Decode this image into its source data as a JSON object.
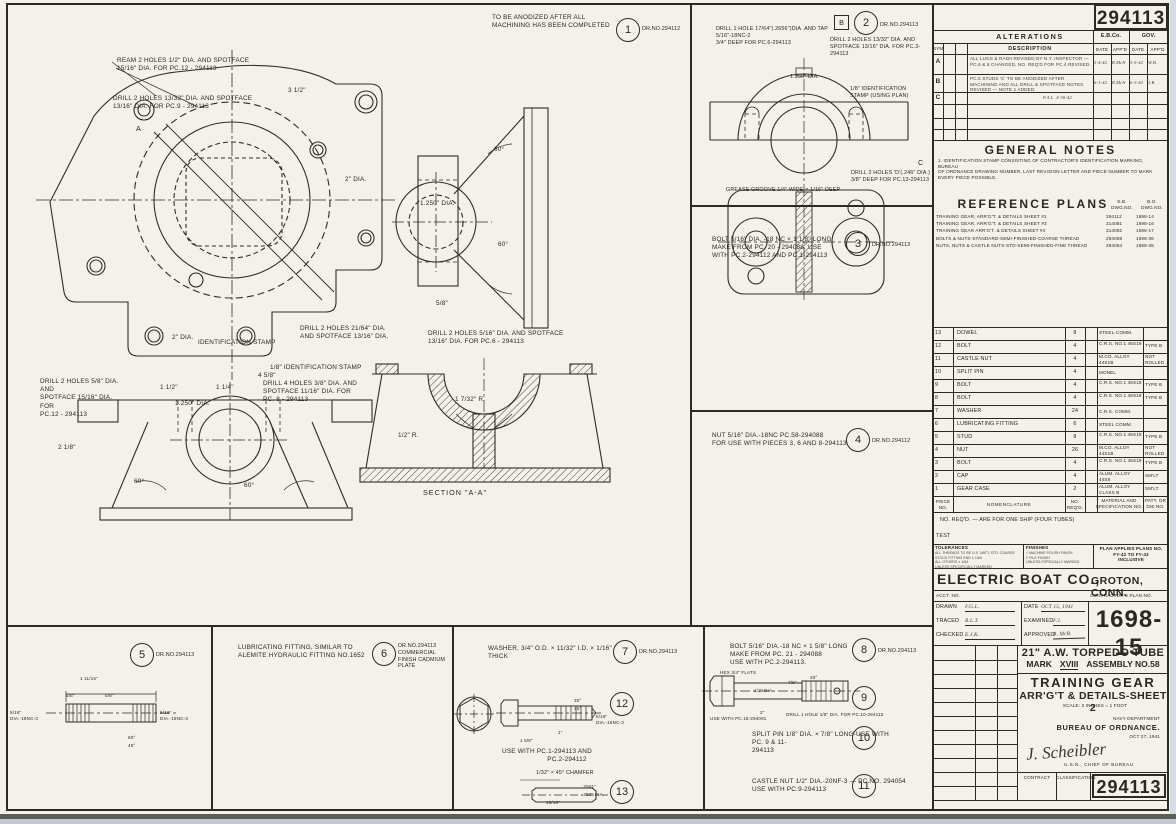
{
  "sheet": {
    "number_top": "294113",
    "number_bottom": "294113",
    "drno": "DR.NO.294113",
    "drno2": "DR.NO.294112"
  },
  "alterations": {
    "title": "ALTERATIONS",
    "ebco": "E.B.Co.",
    "gov": "GOV.",
    "description": "DESCRIPTION",
    "date": "DATE",
    "appd": "APP'D",
    "sym": "SYM",
    "rows": [
      {
        "ltr": "A",
        "desc": "ALL LUGS & RADII REVISED BY N.Y. INSPECTOR — PC.6 & 8 CHANGED, NO. REQ'D FOR PC.4 REVISED.",
        "eb_date": "3-4-42",
        "eb_appd": "R.McN",
        "gov_date": "3-5-42",
        "gov_appd": "W.B."
      },
      {
        "ltr": "B",
        "desc": "PC.5 STUDS 'C' TO BE ANODIZED AFTER MACHINING AND ALL DRILL & SPOTFACE NOTES REVISED — NOTE 1 ADDED.",
        "eb_date": "6-1-42",
        "eb_appd": "R.McN",
        "gov_date": "6-3-42",
        "gov_appd": "J.B."
      },
      {
        "ltr": "C",
        "desc": "",
        "eb_date": "",
        "eb_appd": "",
        "gov_date": "",
        "gov_appd": ""
      }
    ],
    "side_note": "F.A.L. 4-30-42"
  },
  "general_notes": {
    "title": "GENERAL NOTES",
    "note_l1": "1. IDENTIFICATION STAMP CONSISTING OF CONTRACTOR'S IDENTIFICATION MARKING, BUREAU",
    "note_l2": "OF ORDNANCE DRAWING NUMBER, LAST REVISION LETTER AND PIECE NUMBER TO MARK",
    "note_l3": "EVERY PIECE POSSIBLE."
  },
  "reference_plans": {
    "title": "REFERENCE PLANS",
    "col1a": "E.B.",
    "col1b": "DWG.NO.",
    "col2a": "B.O.",
    "col2b": "DWG.NO.",
    "rows": [
      {
        "name": "TRAINING GEAR, ARR'G'T. & DETAILS SHEET #1",
        "eb": "294112",
        "bo": "1698-14"
      },
      {
        "name": "TRAINING GEAR, ARR'G'T. & DETAILS SHEET #3",
        "eb": "314081",
        "bo": "1698-16"
      },
      {
        "name": "TRAINING GEAR ARR'G'T. & DETAILS SHEET #4",
        "eb": "314082",
        "bo": "1698-17"
      },
      {
        "name": "BOLTS & NUTS-STANDARD-SEMI-FINISHED-COARSE THREAD",
        "eb": "294088",
        "bo": "1698-36"
      },
      {
        "name": "NUTS, NUTS & CASTLE NUTS-STD-SEMI-FINISHED-FINE THREAD",
        "eb": "294054",
        "bo": "1698-35"
      }
    ]
  },
  "parts": {
    "rows": [
      {
        "no": "13",
        "name": "DOWEL",
        "qty": "8",
        "mat": "STEEL-COMM.",
        "note": ""
      },
      {
        "no": "12",
        "name": "BOLT",
        "qty": "4",
        "mat": "C.R.S. NO.1 46S18",
        "note": "TYPE B"
      },
      {
        "no": "11",
        "name": "CASTLE NUT",
        "qty": "4",
        "mat": "M.CO. ALLOY 44S1B",
        "note": "NOT ROLLED"
      },
      {
        "no": "10",
        "name": "SPLIT PIN",
        "qty": "4",
        "mat": "MONEL",
        "note": ""
      },
      {
        "no": "9",
        "name": "BOLT",
        "qty": "4",
        "mat": "C.R.S. NO.1 46S18",
        "note": "TYPE B"
      },
      {
        "no": "8",
        "name": "BOLT",
        "qty": "4",
        "mat": "C.R.S. NO.1 46S18",
        "note": "TYPE B"
      },
      {
        "no": "7",
        "name": "WASHER",
        "qty": "24",
        "mat": "C.R.S. COMM.",
        "note": ""
      },
      {
        "no": "6",
        "name": "LUBRICATING FITTING",
        "qty": "6",
        "mat": "STEEL COMM.",
        "note": ""
      },
      {
        "no": "5",
        "name": "STUD",
        "qty": "8",
        "mat": "C.R.S. NO.1 46S18",
        "note": "TYPE B"
      },
      {
        "no": "4",
        "name": "NUT",
        "qty": "26",
        "mat": "M.CO. ALLOY 44S1B",
        "note": "NOT ROLLED"
      },
      {
        "no": "3",
        "name": "BOLT",
        "qty": "4",
        "mat": "C.R.S. NO.1 46S18",
        "note": "TYPE B"
      },
      {
        "no": "2",
        "name": "CAP",
        "qty": "4",
        "mat": "ALUM. ALLOY 44S8",
        "note": "SM'LT"
      },
      {
        "no": "1",
        "name": "GEAR CASE",
        "qty": "2",
        "mat": "ALUM. ALLOY CLASS B",
        "note": "SM'LT"
      }
    ],
    "hdr_no": "PIECE NO.",
    "hdr_name": "NOMENCLATURE",
    "hdr_qty": "NO. REQ'D.",
    "hdr_mat": "MATERIAL AND SPECIFICATION NO.",
    "hdr_note": "PATT. OR DIE NO.",
    "footnote": "NO. REQ'D. — ARE FOR ONE SHIP (FOUR TUBES)",
    "test": "TEST"
  },
  "title_block": {
    "tolerances": "TOLERANCES",
    "tol1": "ALL THREADS TO BE U.S. NAT'L STD. COARSE",
    "tol2": "STOCK FITTING END ± 1/64",
    "tol3": "ALL OTHERS ± 1/64",
    "tol4": "UNLESS SPECIFICALLY MARKED",
    "finishes": "FINISHES",
    "fin1": "√ MACHINE POLISH FINISH",
    "fin2": "F FILE FINISH",
    "fin3": "UNLESS ESPECIALLY MARKED",
    "applies1": "PLAN APPLIES PLANS NO.",
    "applies2": "FY-42 TO FY-43",
    "applies3": "INCLUSIVE",
    "company": "ELECTRIC BOAT CO.,",
    "city": "GROTON, CONN.",
    "acct": "ACCT. NO.",
    "contractors": "CONTRACTOR'S PLAN NO.",
    "drawn_label": "DRAWN",
    "drawn": "F.G.L.",
    "date_label": "DATE",
    "date": "OCT 15, 1941",
    "traced_label": "TRACED",
    "traced": "B.L.T.",
    "examined_label": "EXAMINED",
    "examined": "F.J.",
    "checked_label": "CHECKED",
    "checked": "E.J.K.",
    "approved_label": "APPROVED",
    "approved": "R. McB.",
    "plan_no": "1698-15",
    "tube": "21\" A.W. TORPEDO TUBE",
    "mark_label": "MARK",
    "mark": "XVIII",
    "assembly": "ASSEMBLY NO.58",
    "gear_title": "TRAINING GEAR",
    "gear_sub": "ARR'G'T & DETAILS-SHEET 2",
    "scale": "SCALE: 3 INCHES = 1 FOOT",
    "dept": "NAVY DEPARTMENT",
    "bureau": "BUREAU OF ORDNANCE.",
    "date2": "OCT 27, 1941",
    "signature": "J. Scheibler",
    "sig_sub": "U.S.N., CHIEF OF BUREAU",
    "contract": "CONTRACT",
    "classification": "CLASSIFICATION"
  },
  "det1": {
    "n": "1",
    "l1": "TO BE ANODIZED AFTER ALL",
    "l2": "MACHINING HAS BEEN COMPLETED"
  },
  "det2": {
    "n": "2",
    "b": "B",
    "c": "C",
    "tap1": "DRILL 1 HOLE 17/64\"(.2656\")DIA. AND TAP 5/16\"-18NC-2",
    "tap2": "3/4\" DEEP FOR PC.6-294113",
    "dr1": "DRILL 2 HOLES 13/32\" DIA. AND",
    "dr2": "SPOTFACE 13/16\" DIA. FOR PC.3-294113",
    "bore": "1.250\" DIA.",
    "id1": "1/8\" IDENTIFICATION",
    "id2": "STAMP (USING PLAN)",
    "dd1": "DRILL 2 HOLES 'D'(.246\" DIA.)",
    "dd2": "3/8\" DEEP FOR PC.13-294113",
    "groove": "GREASE GROOVE 1/4\" WIDE × 1/16\" DEEP"
  },
  "det3": {
    "n": "3",
    "l1": "BOLT 5/16\" DIA. -18 NC × 1 1/8\" LONG",
    "l2": "MAKE FROM PC. 20 - 294088. USE",
    "l3": "WITH PC.2-294112 AND PC.1-294113"
  },
  "det4": {
    "n": "4",
    "l1": "NUT 5/16\" DIA.-18NC PC.58-294088",
    "l2": "FOR USE WITH PIECES 3, 6 AND 8-294113"
  },
  "det5": {
    "n": "5",
    "thread": "5/16\" DIA.-18NC-3",
    "len": "1 11/16\"",
    "t": "5/8\"",
    "a60": "60°",
    "a45": "45°"
  },
  "det6": {
    "n": "6",
    "l1": "LUBRICATING FITTING, SIMILAR TO",
    "l2": "ALEMITE HYDRAULIC FITTING NO.1652",
    "f1": "COMMERCIAL",
    "f2": "FINISH CADMIUM",
    "f3": "PLATE"
  },
  "det7": {
    "n": "7",
    "text": "WASHER, 3/4\" O.D. × 11/32\" I.D. × 1/16\" THICK"
  },
  "det8": {
    "n": "8",
    "l1": "BOLT 5/16\" DIA.-18 NC × 1 5/8\" LONG",
    "l2": "MAKE FROM PC. 21 - 294088",
    "l3": "USE WITH PC.2-294113."
  },
  "det9": {
    "n": "9",
    "hex": "HEX 3/4\" FLATS",
    "dia": "1/2\" DIA.",
    "d78": "7/8\"",
    "d2": "2\"",
    "a30": "30°",
    "drill": "DRILL 1 HOLE 1/8\" DIA. FOR PC.10-294113",
    "use": "USE WITH PC.15-294091"
  },
  "det10": {
    "n": "10",
    "l1": "SPLIT PIN 1/8\" DIA. × 7/8\" LONG-USE WITH PC. 9 & 11-",
    "l2": "294113"
  },
  "det11": {
    "n": "11",
    "l1": "CASTLE NUT 1/2\" DIA.-20NF-3 — PC.NO. 294054",
    "l2": "USE WITH PC.9-294113"
  },
  "det12": {
    "n": "12",
    "len": "1 5/8\"",
    "tl": "1\"",
    "use1": "USE WITH PC.1-294113 AND",
    "use2": "PC.2-294112"
  },
  "det13": {
    "n": "13",
    "cham": "1/32\" × 45° CHAMFER",
    "d1": ".2501\"",
    "d2": ".250\" DIA.",
    "len": "15/16\""
  },
  "callouts": {
    "ream1": "REAM 2 HOLES 1/2\" DIA. AND SPOTFACE",
    "ream2": "15/16\" DIA. FOR PC.12 - 294113",
    "d9a": "DRILL 2 HOLES 13/32\" DIA. AND SPOTFACE",
    "d9b": "13/16\" DIA. FOR PC.9 - 294113",
    "d21a": "DRILL 2 HOLES 21/64\" DIA.",
    "d21b": "AND SPOTFACE 13/16\" DIA.",
    "d6a": "DRILL 2 HOLES 5/16\" DIA. AND SPOTFACE",
    "d6b": "13/16\" DIA. FOR PC.6 - 294113",
    "ident": "1/8\" IDENTIFICATION STAMP",
    "ident2": "IDENTIFICATION STAMP",
    "d8a": "DRILL 4 HOLES 3/8\" DIA. AND",
    "d8b": "SPOTFACE 11/16\" DIA. FOR",
    "d8c": "PC. 8 - 294113",
    "d12a": "DRILL 2 HOLES 5/8\" DIA. AND",
    "d12b": "SPOTFACE 15/16\" DIA. FOR",
    "d12c": "PC.12 - 294113",
    "section": "SECTION \"A-A\""
  },
  "dims": {
    "a": "A",
    "p1": "3 1/2\"",
    "p2": "2\" DIA.",
    "p3": "4 5/8\"",
    "e1": "2 1/8\"",
    "e2": "1 1/2\"",
    "e3": "1 1/4\"",
    "bore": "1.250\" DIA.",
    "a60": "60°",
    "f58": "5/8\"",
    "s1": "1 7/32\" R.",
    "s2": "1/2\" R."
  }
}
